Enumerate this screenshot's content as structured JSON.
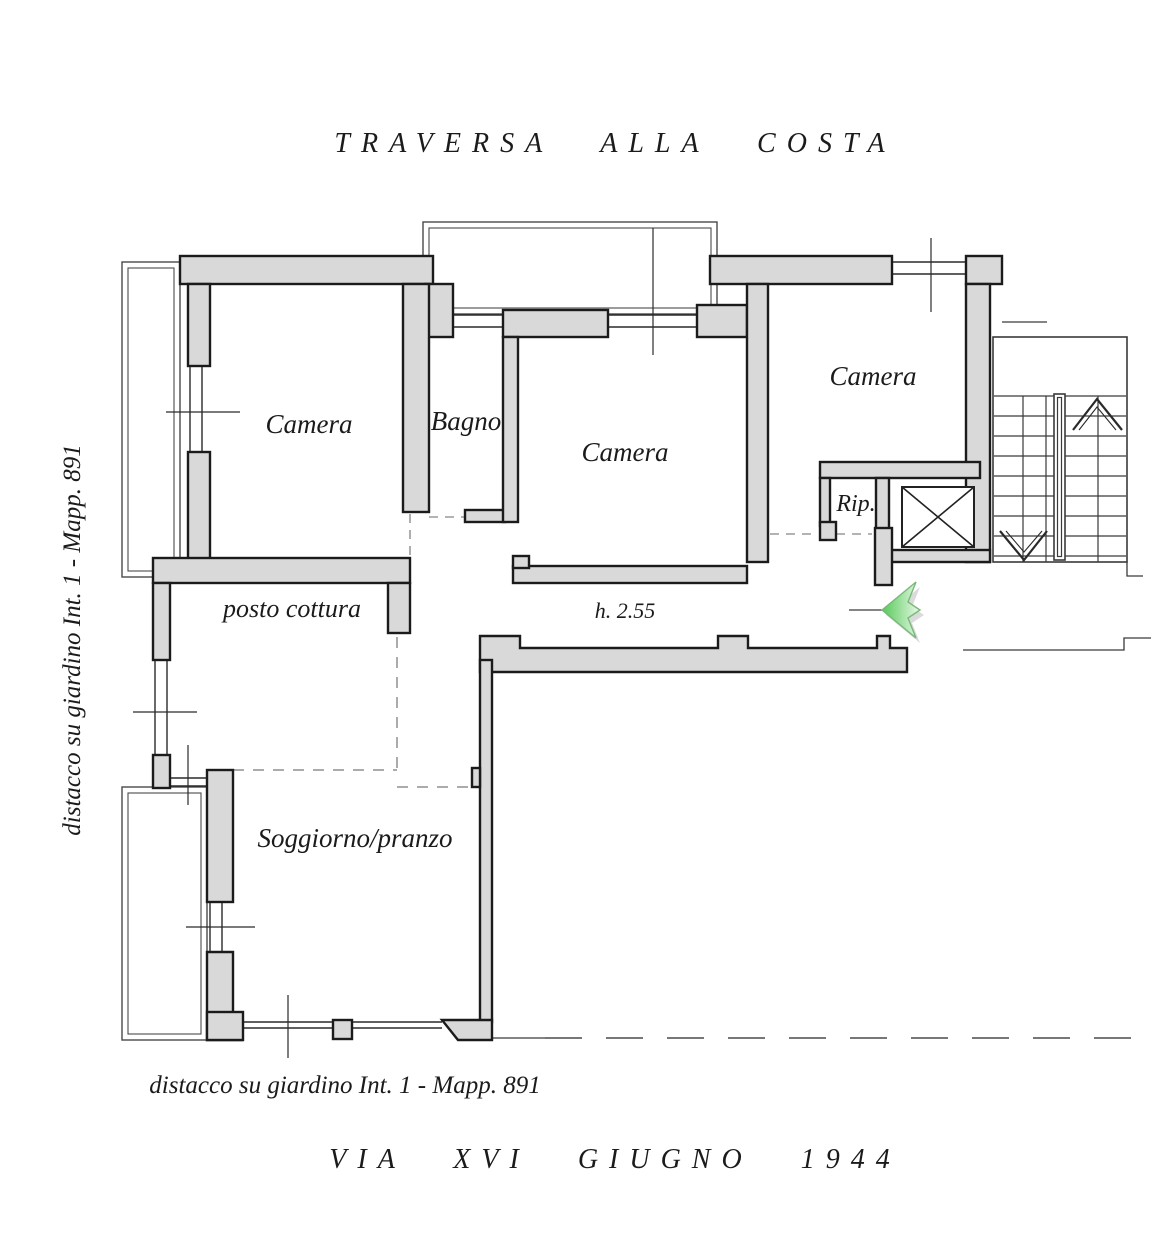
{
  "title_top": "TRAVERSA ALLA COSTA",
  "title_bottom": "VIA XVI GIUGNO 1944",
  "margin_notes": {
    "left": "distacco su giardino Int. 1 - Mapp. 891",
    "bottom": "distacco su giardino Int. 1 - Mapp. 891"
  },
  "rooms": {
    "camera_nw": "Camera",
    "bagno": "Bagno",
    "camera_center": "Camera",
    "camera_ne": "Camera",
    "rip": "Rip.",
    "posto_cottura": "posto cottura",
    "soggiorno": "Soggiorno/pranzo"
  },
  "annotations": {
    "ceiling_height": "h. 2.55"
  },
  "colors": {
    "wall_fill": "#d9d9d9",
    "line": "#1b1b1b",
    "arrow_green": "#55c957"
  }
}
